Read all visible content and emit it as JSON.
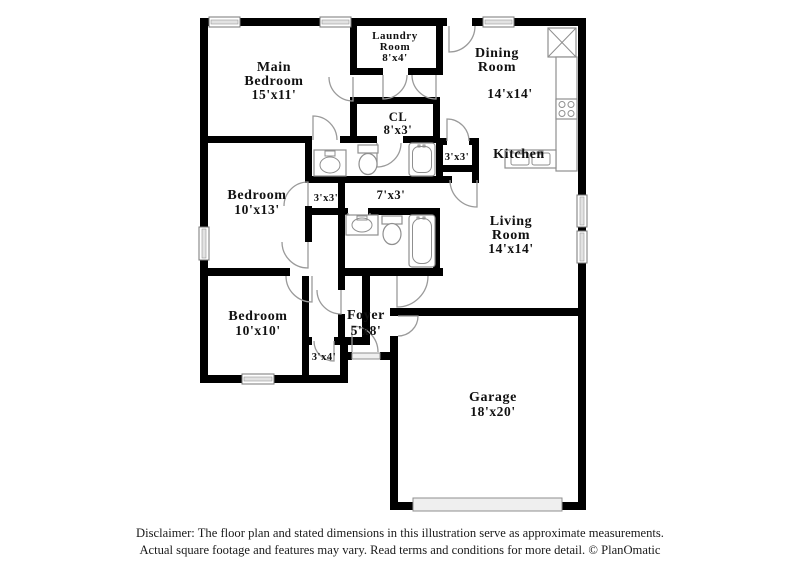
{
  "rooms": {
    "main_bedroom": {
      "line1": "Main",
      "line2": "Bedroom",
      "dims": "15'x11'"
    },
    "laundry_room": {
      "line1": "Laundry",
      "line2": "Room",
      "dims": "8'x4'"
    },
    "dining_room": {
      "line1": "Dining",
      "line2": "Room",
      "dims": "14'x14'"
    },
    "kitchen": {
      "line1": "Kitchen"
    },
    "closet_cl": {
      "line1": "CL",
      "dims": "8'x3'"
    },
    "pantry": {
      "dims": "3'x3'"
    },
    "hall": {
      "dims": "7'x3'"
    },
    "bedroom_2": {
      "line1": "Bedroom",
      "dims": "10'x13'"
    },
    "closet_2": {
      "dims": "3'x3'"
    },
    "bedroom_3": {
      "line1": "Bedroom",
      "dims": "10'x10'"
    },
    "closet_3": {
      "dims": "3'x4'"
    },
    "foyer": {
      "line1": "Foyer",
      "dims": "5'x8'"
    },
    "living_room": {
      "line1": "Living",
      "line2": "Room",
      "dims": "14'x14'"
    },
    "garage": {
      "line1": "Garage",
      "dims": "18'x20'"
    }
  },
  "disclaimer": {
    "line1": "Disclaimer: The floor plan and stated dimensions in this illustration serve as approximate measurements.",
    "line2": "Actual square footage and features may vary. Read terms and conditions for more detail. © PlanOmatic"
  },
  "colors": {
    "wall": "#000000",
    "window_fill": "#e2e2e2",
    "door_stroke": "#9a9a9a",
    "fixture_stroke": "#8f8f8f",
    "text": "#111111",
    "background": "#ffffff"
  }
}
